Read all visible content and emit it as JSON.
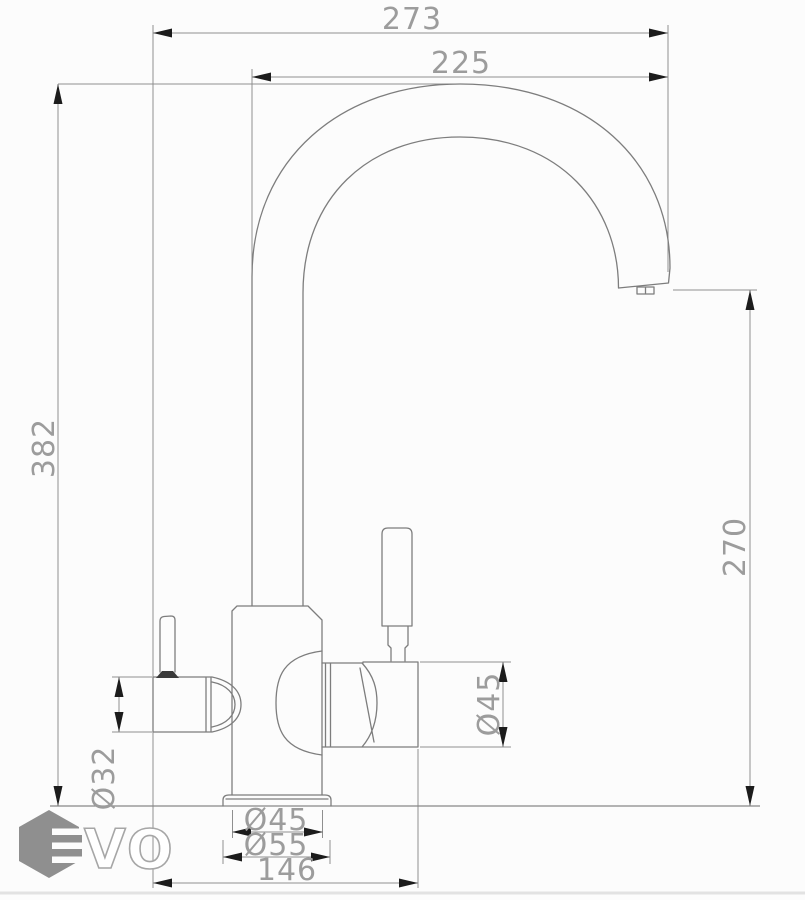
{
  "drawing": {
    "type": "technical-drawing",
    "subject": "kitchen faucet (two-channel mixer with filter outlet), side elevation with dimensions",
    "units": "mm",
    "colors": {
      "outline": "#7d7d7d",
      "dimension_line": "#8f8f8f",
      "dimension_text": "#9c9c9c",
      "arrowhead": "#1c1c1c",
      "background": "#fcfcfc"
    },
    "dimensions": {
      "overall_width": "273",
      "spout_reach": "225",
      "overall_height": "382",
      "spout_outlet_height": "270",
      "handle_body_diameter": "Ø45",
      "filter_spout_diameter": "Ø32",
      "body_diameter": "Ø45",
      "base_flange_diameter": "Ø55",
      "footprint_width": "146"
    },
    "logo": {
      "brand": "EVO",
      "visible_letters": "VO",
      "hexagon_color": "#8f8f8f",
      "letter_outline_color": "#a6a6a6"
    }
  }
}
